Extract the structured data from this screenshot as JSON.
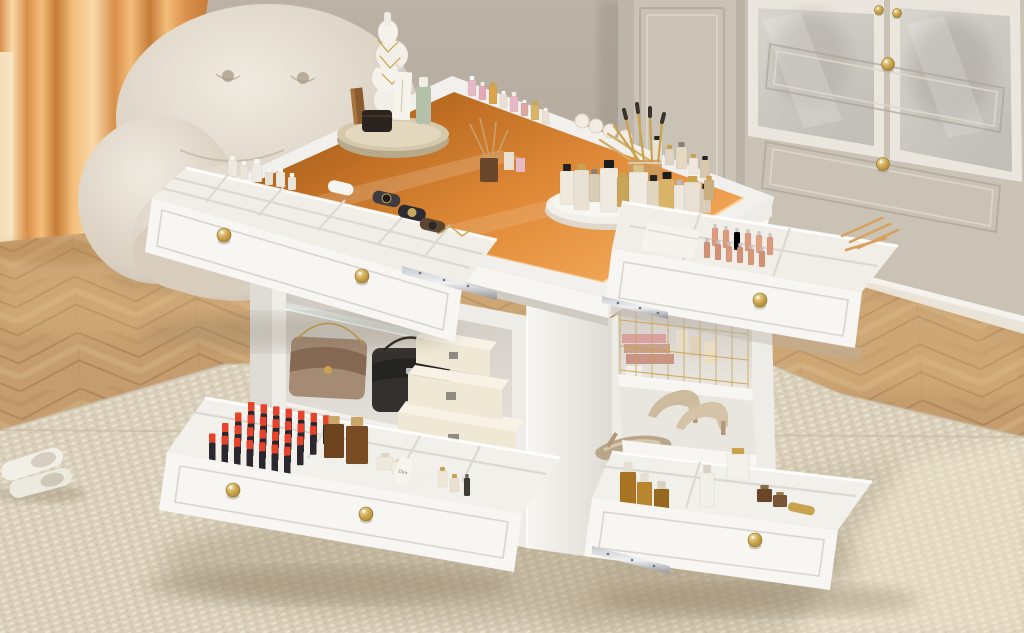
{
  "labels": {
    "dior_tube": "Dior"
  },
  "palette": {
    "wall": "#aea496",
    "wallLight": "#bcb3a6",
    "wallDark": "#9a9083",
    "window": "#f6e7c6",
    "curtainA": "#f3bd7a",
    "curtainB": "#d98f4a",
    "curtainC": "#f9d9a8",
    "curtainD": "#c47c38",
    "chairHi": "#f0ebe1",
    "chairMid": "#d9cfc0",
    "chairLo": "#b3a492",
    "chairCrease": "#b5a896",
    "wood": "#c59c6d",
    "woodDark": "#a87f52",
    "woodLight": "#dab88a",
    "woodSeam": "#97744b",
    "rug": "#d9cfba",
    "rugDark": "#c3b79e",
    "rugLight": "#ece4d2",
    "white": "#f8f6f2",
    "white2": "#eeecE7",
    "white3": "#dedbd4",
    "slit": "#cfcac2",
    "interiorDark": "#cfc9c1",
    "interiorLight": "#eae7e1",
    "amber1": "#8f5318",
    "amber2": "#c06f24",
    "amber3": "#e08a38",
    "amber4": "#f2a858",
    "amberGlare": "#ffdca8",
    "gold": "#c9a24a",
    "goldDeep": "#9a7426",
    "goldHi": "#f3dfa2",
    "wardrobe": "#c9c2b5",
    "wardrobeDark": "#aaa295",
    "wardrobeLight": "#ddd7cb",
    "frameWhite": "#eae6dd",
    "pane1": "#d8d5cf",
    "pane2": "#c2beb8",
    "metal": "#c6c9cd",
    "metalDark": "#8f9296",
    "lipRed": "#e8432a",
    "lipBody": "#2a282e",
    "bagTaupe": "#a58a74",
    "bagTaupeDark": "#866953",
    "bagBlack": "#33302d",
    "cream": "#efe8d5",
    "creamHi": "#f7f2e4",
    "creamLo": "#d9cfb4",
    "heel": "#cdbb9e",
    "heelDark": "#b0997a",
    "sage": "#b5c0a8",
    "trayWood": "#d5c8ab",
    "trayWoodSide": "#b7a98c",
    "diffuser": "#6a472a",
    "sticks": "#c9a06a",
    "pink": "#e7b9c6",
    "roseGold": "#dd9b7c"
  },
  "items": {
    "knobs": [
      [
        224,
        235,
        7
      ],
      [
        362,
        276,
        7
      ],
      [
        760,
        300,
        7
      ],
      [
        233,
        490,
        7
      ],
      [
        366,
        514,
        7
      ],
      [
        755,
        540,
        7
      ],
      [
        879,
        10,
        4.5
      ],
      [
        897,
        13,
        4.5
      ],
      [
        888,
        64,
        6.5
      ],
      [
        883,
        164,
        6.5
      ]
    ],
    "bottle_groups": [
      {
        "target": "g-tray-perfumes",
        "items": [
          [
            560,
            205,
            14,
            34,
            "#efe9de",
            "#222222",
            7
          ],
          [
            574,
            210,
            15,
            40,
            "#e9e2d4",
            "#c9a24e",
            6
          ],
          [
            589,
            202,
            11,
            28,
            "#d9cdb6",
            "#8a8275",
            5
          ],
          [
            600,
            212,
            18,
            44,
            "#efeae0",
            "#1d1c1a",
            8
          ],
          [
            617,
            207,
            12,
            30,
            "#c9a55a",
            "#caa24e",
            5
          ],
          [
            629,
            214,
            19,
            42,
            "#f0ebe1",
            "#d9c18a",
            7
          ],
          [
            647,
            209,
            13,
            28,
            "#e2d4bd",
            "#242424",
            6
          ],
          [
            659,
            215,
            16,
            36,
            "#d9b368",
            "#1d1c1a",
            7
          ],
          [
            674,
            211,
            11,
            26,
            "#eee8dd",
            "#b9b9b9",
            5
          ],
          [
            684,
            216,
            17,
            34,
            "#e8e0d2",
            "#c9a24e",
            6
          ],
          [
            700,
            213,
            11,
            24,
            "#d9cdb9",
            "#242424",
            5
          ],
          [
            704,
            200,
            10,
            20,
            "#c9b083",
            "#caa24e",
            4
          ]
        ]
      },
      {
        "target": "g-rail-polishes",
        "items": [
          [
            468,
            96,
            8,
            16,
            "#e7b9c6",
            "#ffffff",
            4
          ],
          [
            479,
            100,
            7,
            14,
            "#e4a8b8",
            "#efece6",
            4
          ],
          [
            489,
            104,
            8,
            18,
            "#d9a44c",
            "#caa24e",
            4
          ],
          [
            500,
            108,
            7,
            14,
            "#eadfd2",
            "#ffffff",
            3
          ],
          [
            510,
            112,
            8,
            16,
            "#e7b9c6",
            "#efece6",
            4
          ],
          [
            521,
            116,
            7,
            13,
            "#dca8a0",
            "#ffffff",
            3
          ],
          [
            531,
            120,
            8,
            15,
            "#d9b368",
            "#caa24e",
            4
          ],
          [
            542,
            124,
            7,
            13,
            "#eadfd2",
            "#ffffff",
            3
          ]
        ]
      },
      {
        "target": "g-rail-minis",
        "items": [
          [
            652,
            160,
            10,
            20,
            "#e9e2d6",
            "#242424",
            4
          ],
          [
            665,
            165,
            9,
            16,
            "#dfd5c4",
            "#c9a24e",
            4
          ],
          [
            676,
            169,
            11,
            22,
            "#e6d9c2",
            "#8a8275",
            5
          ],
          [
            689,
            174,
            9,
            16,
            "#efe9de",
            "#c9a24e",
            4
          ],
          [
            700,
            178,
            10,
            18,
            "#d9c9ae",
            "#242424",
            4
          ]
        ]
      },
      {
        "target": "g-drawer-glosses",
        "items": [
          [
            712,
            246,
            6,
            18,
            "#dd9b7c",
            "#c9c9ca",
            4
          ],
          [
            723,
            248,
            6,
            18,
            "#dd9b7c",
            "#c9c9ca",
            4
          ],
          [
            734,
            250,
            6,
            18,
            "#d79272,",
            "#c9c9ca",
            4
          ],
          [
            745,
            251,
            6,
            18,
            "#dd9b7c",
            "#c9c9ca",
            4
          ],
          [
            756,
            253,
            6,
            18,
            "#e2a485",
            "#c9c9ca",
            4
          ],
          [
            767,
            255,
            6,
            18,
            "#dd9b7c",
            "#c9c9ca",
            4
          ],
          [
            704,
            258,
            6,
            16,
            "#d19176",
            "#bfbfc2",
            4
          ],
          [
            715,
            260,
            6,
            16,
            "#d19176",
            "#bfbfc2",
            4
          ],
          [
            726,
            262,
            6,
            16,
            "#da9a7d",
            "#bfbfc2",
            4
          ],
          [
            737,
            263,
            6,
            16,
            "#d19176",
            "#bfbfc2",
            4
          ],
          [
            748,
            265,
            6,
            16,
            "#d79878",
            "#bfbfc2",
            4
          ],
          [
            759,
            267,
            6,
            16,
            "#d19176",
            "#bfbfc2",
            4
          ]
        ]
      },
      {
        "target": "g-backrow-jars",
        "items": [
          [
            228,
            176,
            9,
            16,
            "#eee9e0",
            "#f7f5f0",
            4
          ],
          [
            240,
            179,
            8,
            14,
            "#eae4d9",
            "#f7f5f0",
            4
          ],
          [
            252,
            182,
            10,
            18,
            "#f0ebe2",
            "#f7f5f0",
            5
          ],
          [
            265,
            185,
            8,
            13,
            "#e8e2d6",
            "#f7f5f0",
            4
          ],
          [
            276,
            187,
            9,
            15,
            "#eee9e0",
            "#f7f5f0",
            4
          ],
          [
            288,
            190,
            8,
            13,
            "#eae4d9",
            "#f7f5f0",
            4
          ]
        ]
      },
      {
        "target": "g-bl-bottles",
        "items": [
          [
            324,
            458,
            20,
            34,
            "#6e4420",
            "#caa66a",
            8
          ],
          [
            346,
            464,
            22,
            38,
            "#7a4c24",
            "#caa66a",
            9
          ],
          [
            377,
            470,
            16,
            13,
            "#efe9dd",
            "#e0d6c2",
            4
          ],
          [
            392,
            474,
            14,
            12,
            "#f2ece2",
            "#e0d6c2",
            3
          ],
          [
            438,
            487,
            9,
            16,
            "#efe7d6",
            "#c9a24e",
            4
          ],
          [
            450,
            492,
            9,
            14,
            "#e9e0cf",
            "#c9a24e",
            4
          ],
          [
            464,
            496,
            6,
            18,
            "#403a34",
            "#6a6258",
            4
          ]
        ]
      },
      {
        "target": "g-br-bottles",
        "items": [
          [
            620,
            512,
            16,
            40,
            "#a87424",
            "#e5dfd2",
            10
          ],
          [
            637,
            518,
            15,
            36,
            "#b8862f",
            "#e5dfd2",
            9
          ],
          [
            654,
            522,
            15,
            33,
            "#96681f",
            "#d9d2c4",
            8
          ],
          [
            700,
            507,
            14,
            34,
            "#f2efe8",
            "#d9d2c4",
            8
          ],
          [
            727,
            480,
            22,
            26,
            "#f4f1ea",
            "#c9a24e",
            6
          ],
          [
            757,
            502,
            15,
            13,
            "#6a452a",
            "#8a6a42",
            4
          ],
          [
            773,
            507,
            14,
            12,
            "#7a5536",
            "#9a7a4e",
            3
          ]
        ]
      }
    ],
    "lipsticks": {
      "target": "g-lipsticks",
      "rows": 4,
      "cols": 7,
      "x0": 248,
      "y0": 402,
      "colDx": 12.5,
      "colDy": 2.2,
      "rowDx": -13,
      "rowDy": 10.5,
      "w": 6.5,
      "capH": 9,
      "bodyH": 20
    },
    "sponges": {
      "target": "g-rail-sponges",
      "r": 7,
      "fill": "#f3ece2",
      "stroke": "#ddd2c2",
      "points": [
        [
          582,
          121
        ],
        [
          596,
          126
        ],
        [
          610,
          131
        ],
        [
          625,
          137
        ]
      ]
    },
    "line_groups": [
      {
        "target": "g-rail-swabs",
        "color": "#d9a05c",
        "width": 2.5,
        "lines": [
          [
            842,
            236,
            882,
            218
          ],
          [
            850,
            242,
            890,
            224
          ],
          [
            858,
            248,
            898,
            230
          ],
          [
            846,
            250,
            886,
            238
          ]
        ]
      },
      {
        "target": "g-brushes",
        "color": "#c9a24a",
        "width": 2.2,
        "lines": [
          [
            636,
            162,
            626,
            118
          ],
          [
            644,
            162,
            638,
            112
          ],
          [
            652,
            162,
            650,
            116
          ],
          [
            658,
            164,
            662,
            122
          ],
          [
            640,
            162,
            614,
            126
          ]
        ]
      },
      {
        "target": "g-brush-tips",
        "color": "#3a332c",
        "width": 4,
        "lines": [
          [
            626,
            118,
            624,
            110
          ],
          [
            638,
            112,
            637,
            104
          ],
          [
            650,
            116,
            650,
            108
          ],
          [
            662,
            122,
            664,
            114
          ]
        ]
      },
      {
        "target": "g-pencils",
        "color": "#d4af6a",
        "width": 2.5,
        "lines": [
          [
            600,
            140,
            646,
            170
          ],
          [
            608,
            134,
            652,
            162
          ]
        ]
      },
      {
        "target": "g-chain",
        "color": "#c9a24a",
        "width": 1.3,
        "lines": [
          [
            438,
            234,
            450,
            226
          ],
          [
            450,
            226,
            462,
            236
          ],
          [
            462,
            236,
            474,
            228
          ]
        ]
      },
      {
        "target": "g-necklace",
        "color": "#c9a24a",
        "width": 1.2,
        "lines": [
          [
            378,
            40,
            388,
            52
          ],
          [
            388,
            52,
            398,
            42
          ],
          [
            380,
            56,
            390,
            68
          ],
          [
            390,
            68,
            400,
            58
          ],
          [
            382,
            74,
            392,
            84
          ],
          [
            392,
            84,
            402,
            74
          ]
        ]
      }
    ],
    "wire_basket": {
      "target": "g-wires",
      "color": "#c9a24a",
      "x0": 620,
      "x1": 748,
      "step": 16,
      "yTop": 306,
      "yBot": 388,
      "slope": 0.11,
      "hys": [
        320,
        346,
        370
      ],
      "hRise": 14
    }
  }
}
